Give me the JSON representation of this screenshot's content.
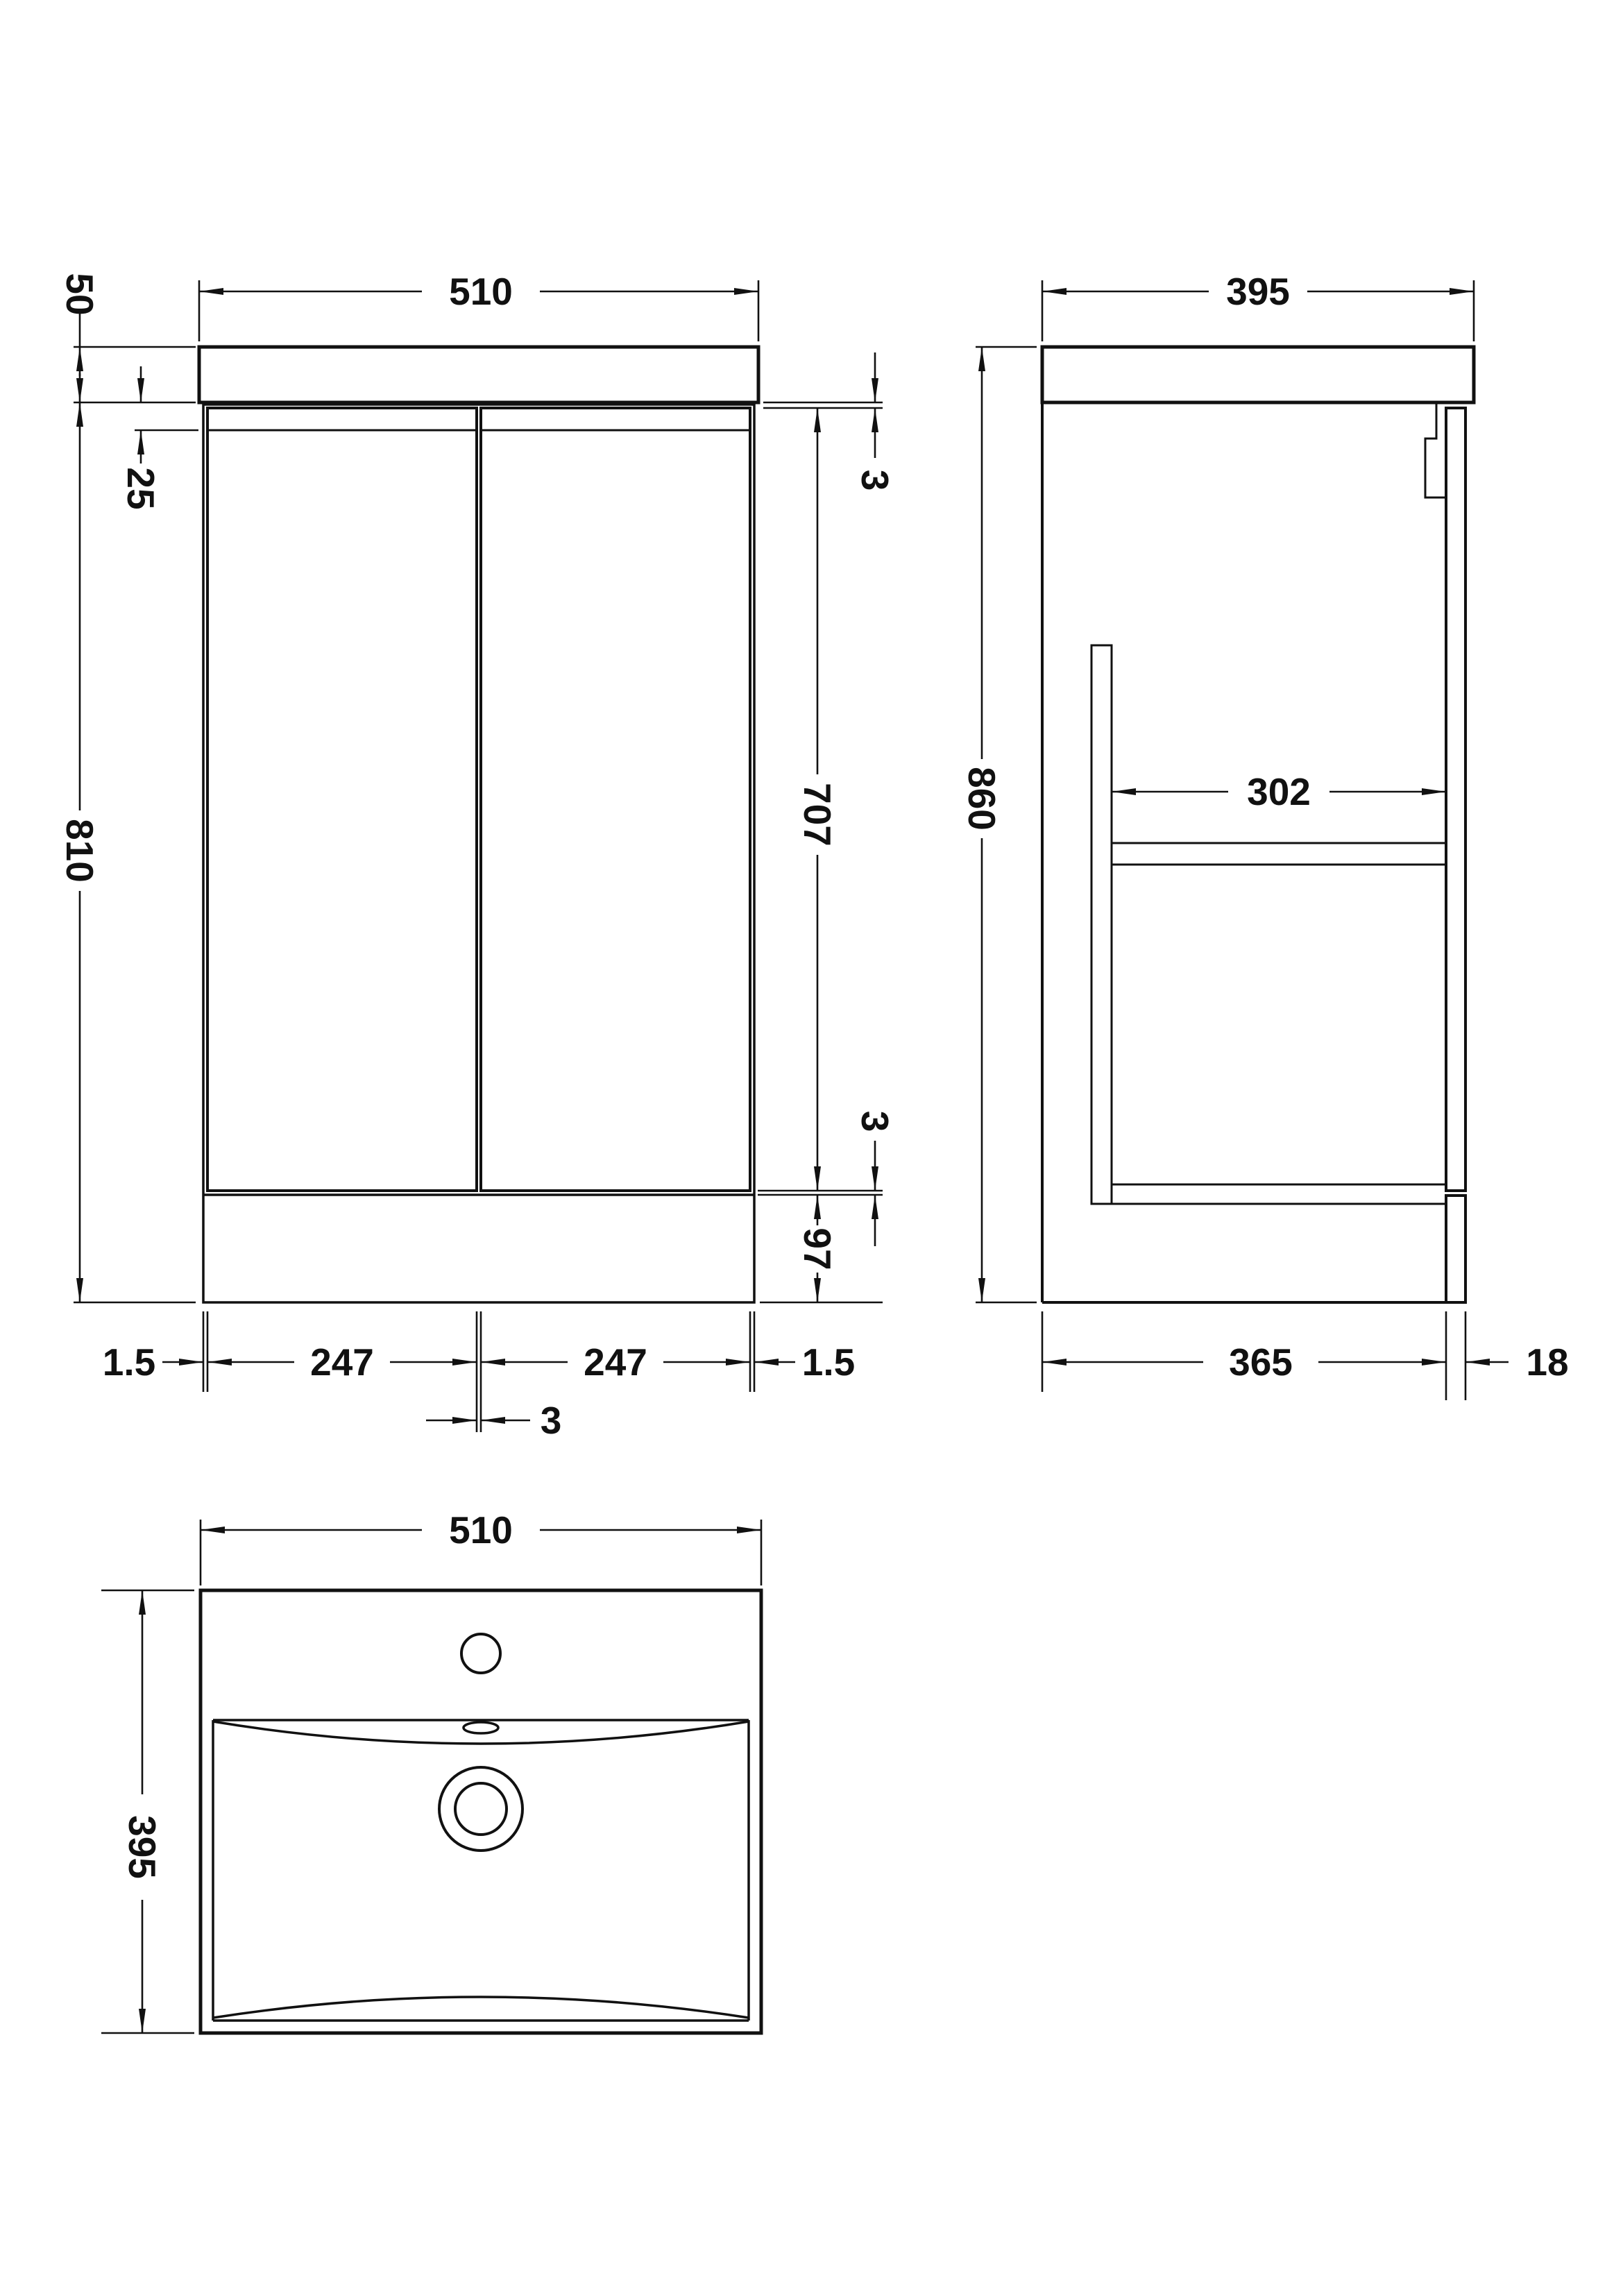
{
  "drawing": {
    "type": "technical-dimension-drawing",
    "subject": "floor-standing vanity unit with basin",
    "units": "mm",
    "line_color": "#111111",
    "background_color": "#ffffff",
    "views": {
      "front": {
        "name": "front elevation",
        "dims": {
          "overall_width": "510",
          "worktop_thickness": "50",
          "door_recess": "25",
          "cabinet_height": "810",
          "top_gap": "3",
          "door_height": "707",
          "bottom_gap": "3",
          "plinth_height": "97",
          "left_edge_gap": "1.5",
          "left_door_width": "247",
          "right_door_width": "247",
          "right_edge_gap": "1.5",
          "centre_door_gap": "3"
        }
      },
      "side": {
        "name": "side elevation",
        "dims": {
          "overall_depth": "395",
          "overall_height": "860",
          "internal_depth": "302",
          "carcass_depth": "365",
          "door_thickness": "18"
        }
      },
      "plan": {
        "name": "basin plan",
        "dims": {
          "basin_width": "510",
          "basin_depth": "395"
        }
      }
    }
  }
}
